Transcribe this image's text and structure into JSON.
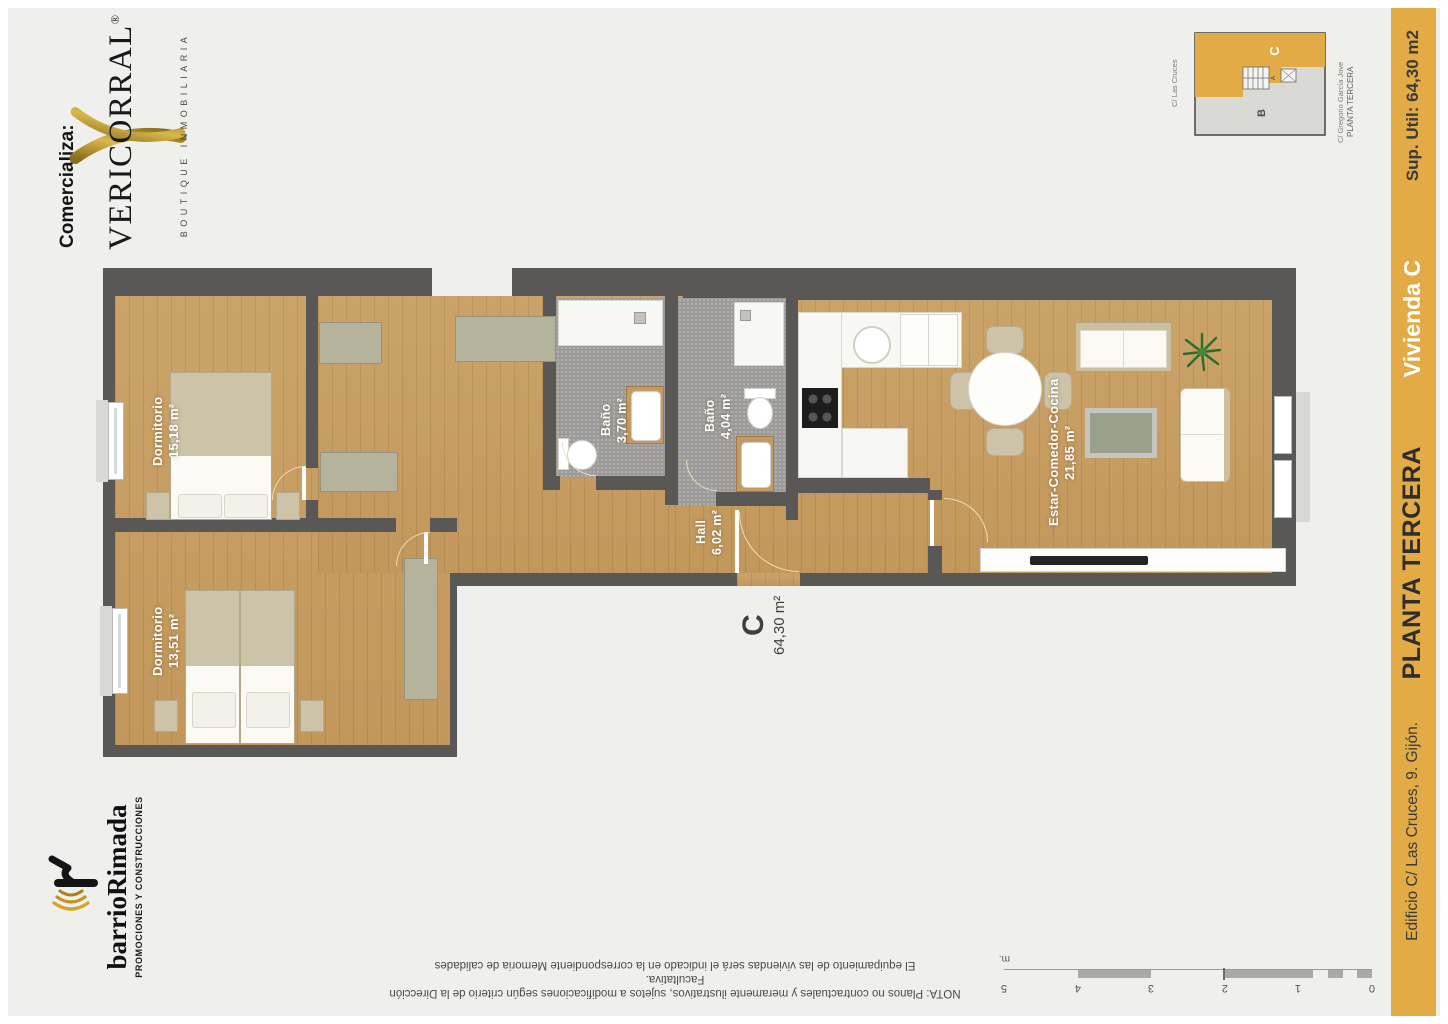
{
  "marketer": {
    "prefix": "Comercializa:",
    "brand": "VERICORRAL",
    "registered": "®",
    "tagline": "BOUTIQUE INMOBILIARIA",
    "gold": "#b08d2f"
  },
  "developer": {
    "name": "barrioRimada",
    "tagline": "PROMOCIONES Y CONSTRUCCIONES"
  },
  "info_band": {
    "background": "#e2ab45",
    "sup_util": "Sup. Util: 64,30 m2",
    "unit": "Vivienda C",
    "floor": "PLANTA TERCERA",
    "address": "Edificio C/ Las Cruces, 9. Gijón."
  },
  "key_plan": {
    "street_left": "C/ Las Cruces",
    "street_right": "C/ Gregorio García Jove",
    "floor": "PLANTA TERCERA",
    "unit_highlighted": "C",
    "unit_other": "B",
    "unit_stairs": "A",
    "highlight_color": "#e2ab45"
  },
  "floor_plan": {
    "unit_label": "C",
    "unit_area": "64,30 m²",
    "rooms": [
      {
        "name": "Dormitorio",
        "area": "15,18 m²"
      },
      {
        "name": "Dormitorio",
        "area": "13,51 m²"
      },
      {
        "name": "Baño",
        "area": "3,70 m²"
      },
      {
        "name": "Baño",
        "area": "4,04 m²"
      },
      {
        "name": "Hall",
        "area": "6,02 m²"
      },
      {
        "name": "Estar-Comedor-Cocina",
        "area": "21,85 m²"
      }
    ]
  },
  "note": {
    "line1": "NOTA: Planos no contractuales y meramente ilustrativos, sujetos a modificaciones según criterio de la Dirección Facultativa.",
    "line2": "El equipamiento de las viviendas será el indicado en la correspondiente Memoria de calidades"
  },
  "scale_bar": {
    "ticks": [
      "0",
      "1",
      "2",
      "3",
      "4",
      "5"
    ],
    "unit": "m."
  }
}
